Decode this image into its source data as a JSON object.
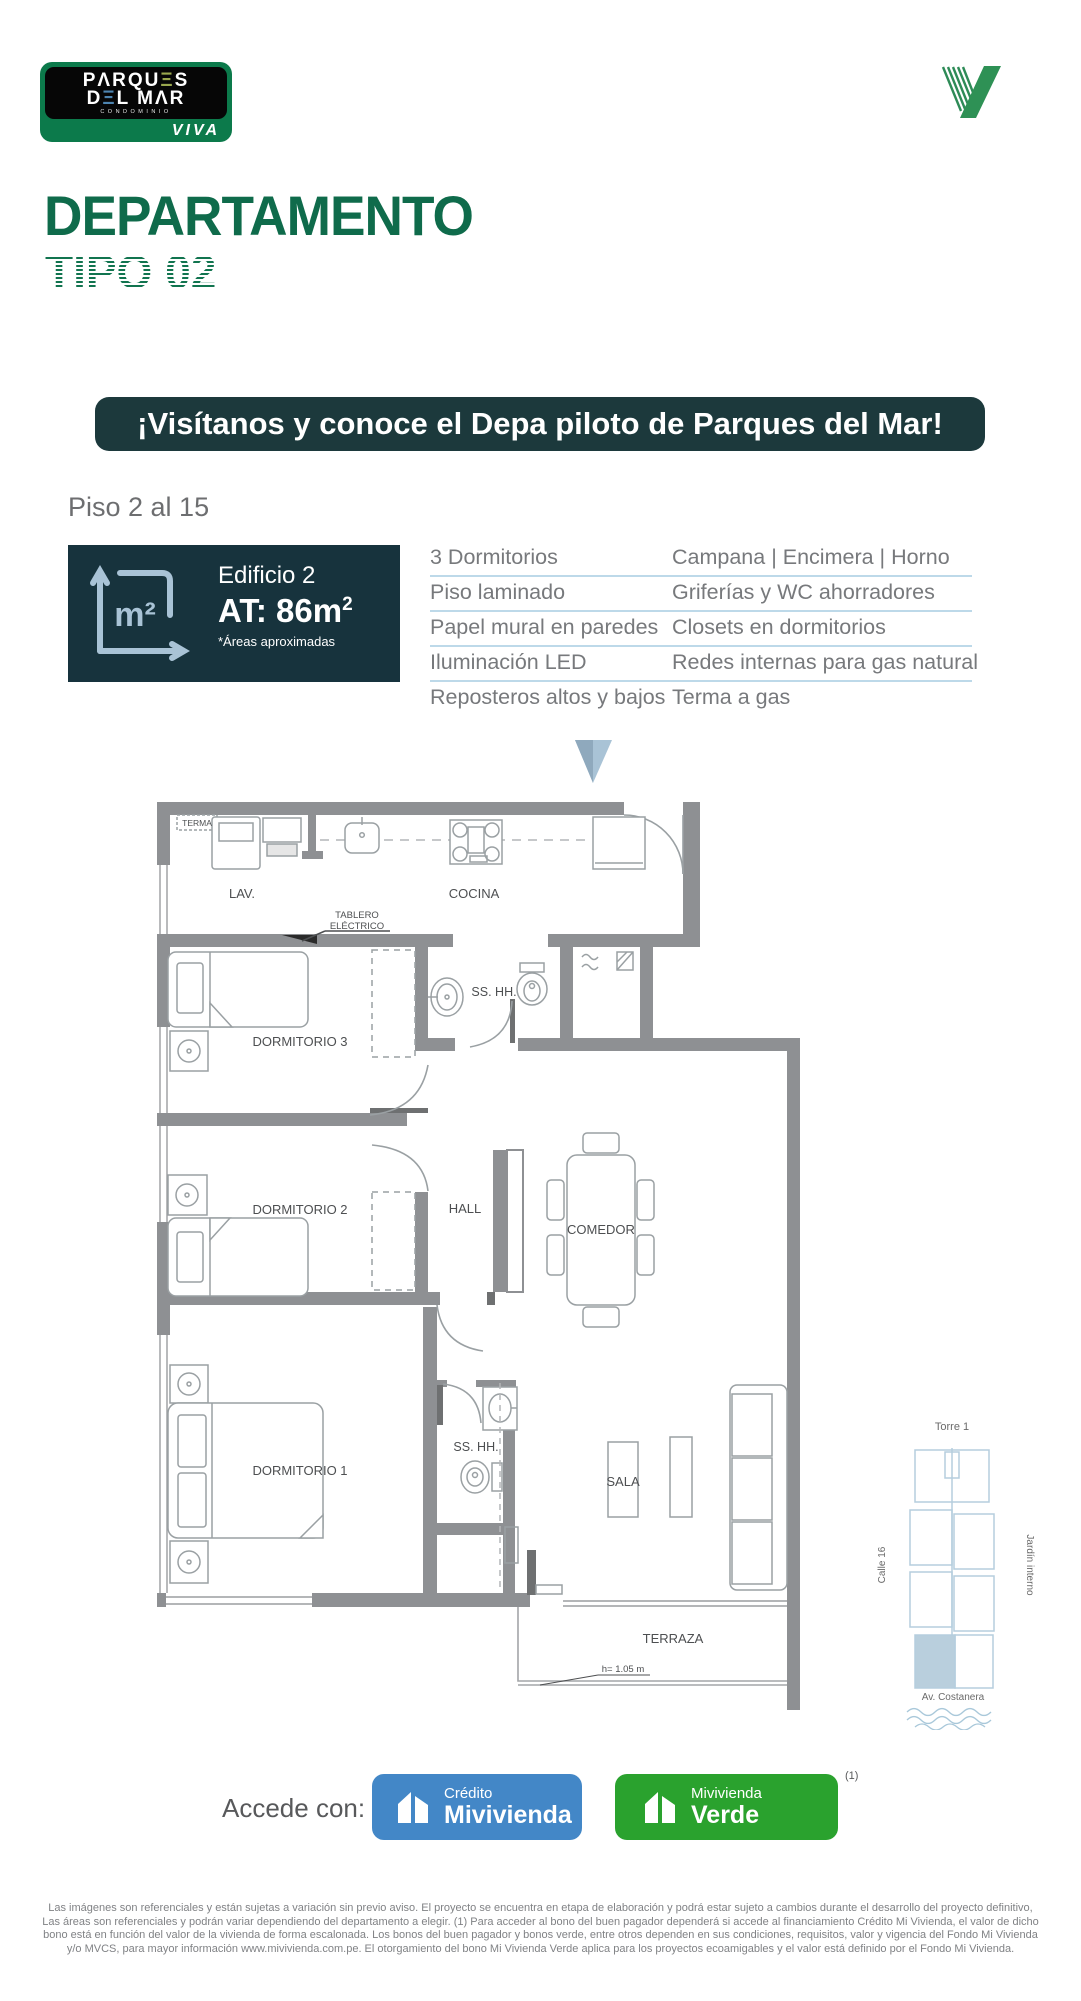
{
  "header": {
    "logo": {
      "l1a": "PΛRQU",
      "l1b": "Ξ",
      "l1c": "S",
      "l2a": "D",
      "l2b": "Ξ",
      "l2c": "L MΛR",
      "sub": "CONDOMINIO",
      "brand": "VIVA"
    }
  },
  "title": {
    "main": "DEPARTAMENTO",
    "sub": "TIPO 02"
  },
  "banner": {
    "text": "¡Visítanos y conoce el Depa piloto de Parques del Mar!"
  },
  "floor_info": {
    "floors": "Piso 2 al 15",
    "building": "Edificio 2",
    "area": "AT: 86m",
    "area_sup": "2",
    "area_note": "*Áreas aproximadas",
    "icon_label": "m²"
  },
  "features": {
    "col1": [
      "3 Dormitorios",
      "Piso laminado",
      "Papel mural en paredes",
      "Iluminación LED",
      "Reposteros altos y bajos"
    ],
    "col2": [
      "Campana | Encimera | Horno",
      "Griferías y WC ahorradores",
      "Closets en dormitorios",
      "Redes internas para gas natural",
      "Terma a gas"
    ]
  },
  "plan": {
    "labels": {
      "terma": "TERMA",
      "lav": "LAV.",
      "cocina": "COCINA",
      "tablero1": "TABLERO",
      "tablero2": "ELÉCTRICO",
      "dorm3": "DORMITORIO 3",
      "bath1": "SS. HH.",
      "dorm2": "DORMITORIO 2",
      "hall": "HALL",
      "comedor": "COMEDOR",
      "dorm1": "DORMITORIO 1",
      "bath2": "SS. HH.",
      "sala": "SALA",
      "terraza": "TERRAZA",
      "h_note": "h= 1.05 m"
    }
  },
  "site_map": {
    "torre": "Torre 1",
    "calle": "Calle 16",
    "jardin": "Jardín interno",
    "avenida": "Av. Costanera"
  },
  "cta": {
    "label": "Accede con:",
    "btn1_top": "Crédito",
    "btn1_bottom": "Mivivienda",
    "btn2_top": "Mivivienda",
    "btn2_bottom": "Verde",
    "note": "(1)"
  },
  "disclaimer": "Las imágenes son referenciales y están sujetas a variación sin previo aviso. El proyecto se encuentra en etapa de elaboración y podrá estar sujeto a cambios durante el desarrollo del proyecto definitivo, Las áreas son referenciales y podrán variar dependiendo del departamento a elegir. (1) Para acceder al bono del buen pagador dependerá si accede al financiamiento Crédito Mi Vivienda, el valor de dicho bono está en función del valor de la vivienda de forma escalonada. Los bonos del buen pagador y bonos verde, entre otros dependen en sus condiciones, requisitos, valor y vigencia del Fondo Mi Vivienda y/o MVCS, para mayor información www.mivivienda.com.pe. El otorgamiento del bono Mi Vivienda Verde aplica para los proyectos ecoamigables y el valor está definido por el Fondo Mi Vivienda.",
  "colors": {
    "brand_green": "#0f6b4b",
    "banner_bg": "#1c393c",
    "infobox_bg": "#17333d",
    "accent_blue": "#a9c3d6",
    "divider_blue": "#bdd9e9",
    "btn_blue": "#4387c7",
    "btn_green": "#2aa22e",
    "wall_gray": "#8e9093"
  }
}
